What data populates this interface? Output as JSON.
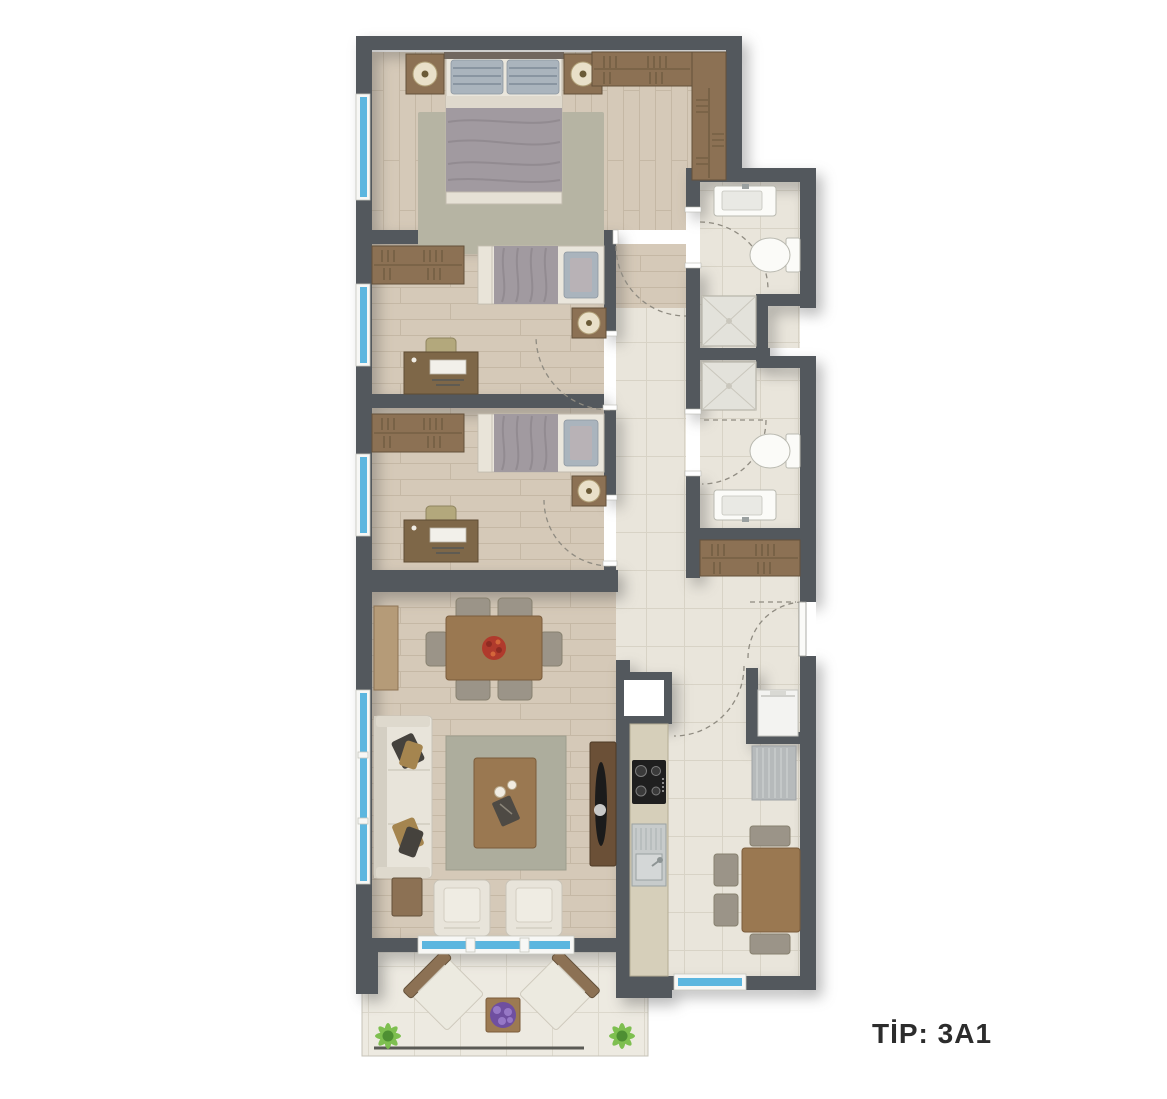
{
  "title": {
    "label": "TİP: 3A1"
  },
  "colors": {
    "text": "#2c2c2c",
    "wall": "#53585d",
    "wood": "#d5c9b8",
    "woodLine": "#c5b8a5",
    "tile": "#e9e5db",
    "tileLine": "#d8d3c6",
    "balconyTile": "#edeae1",
    "balconyTileLine": "#dcd8cc",
    "wardrobe": "#8c7154",
    "wardrobeDark": "#64513a",
    "window": "#5cb6df",
    "windowFrame": "#f7f7f5",
    "blanket": "#a19aa0",
    "blanketShade": "#8b848a",
    "sheet": "#eae6dc",
    "pillowBase": "#aab4bd",
    "pillowStripe": "#7e8b98",
    "rug": "#b6b4a3",
    "rugLiving": "#adad9d",
    "tableWood": "#9a7851",
    "tableWoodDark": "#7b5c3b",
    "chairGray": "#9b9488",
    "deskWood": "#7e6748",
    "chairKhaki": "#b3a87c",
    "sofa": "#e8e4da",
    "sofaShade": "#d4cfc3",
    "cushionDark": "#45423d",
    "cushionTan": "#a5854f",
    "tvBoard": "#6b5037",
    "tvBlack": "#1b1b1b",
    "counter": "#d6cfba",
    "counterEdge": "#b4ac94",
    "steel": "#c7cbcb",
    "steelDark": "#9aa1a1",
    "fridge": "#b6babb",
    "fixtureWhite": "#fbfbf8",
    "fixtureStroke": "#b9b9b0",
    "shower": "#e3e2db",
    "showerBorder": "#b7b4a9",
    "nightstand": "#8c7154",
    "plantGreen1": "#4e8f33",
    "plantGreen2": "#79bd49",
    "plantPurple": "#6f4fa0",
    "plantPurple2": "#9678c6",
    "flowerRed": "#b03a2c",
    "arcDash": "#8f8b81"
  }
}
